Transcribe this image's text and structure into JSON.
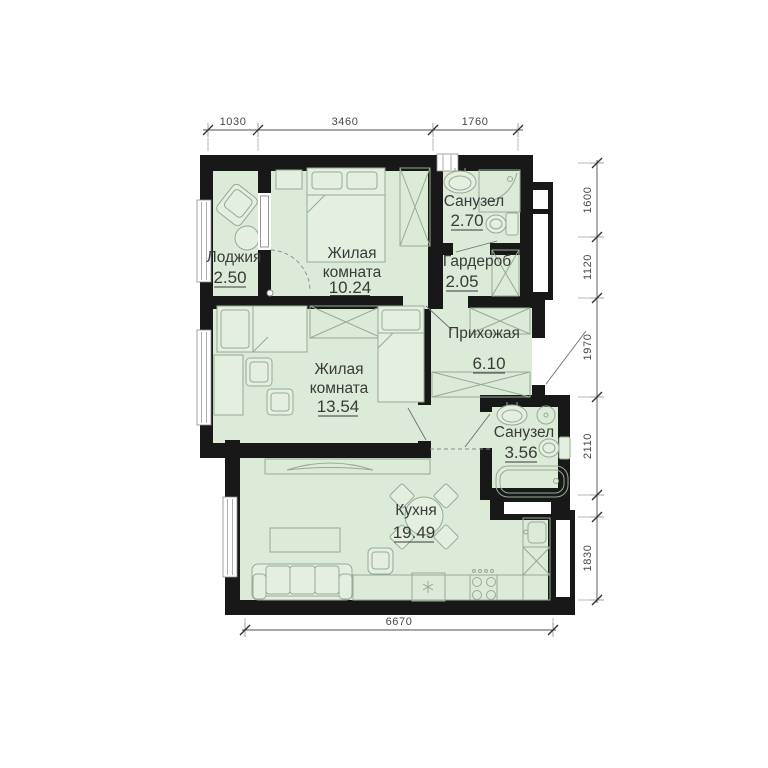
{
  "plan": {
    "type": "apartment-floor-plan",
    "rooms": [
      {
        "label": "Лоджия",
        "area": "2.50"
      },
      {
        "label_line1": "Жилая",
        "label_line2": "комната",
        "area": "10.24"
      },
      {
        "label": "Санузел",
        "area": "2.70"
      },
      {
        "label": "Гардероб",
        "area": "2.05"
      },
      {
        "label": "Прихожая",
        "area": "6.10"
      },
      {
        "label_line1": "Жилая",
        "label_line2": "комната",
        "area": "13.54"
      },
      {
        "label": "Санузел",
        "area": "3.56"
      },
      {
        "label": "Кухня",
        "area": "19.49"
      }
    ],
    "dimensions": {
      "top": [
        "1030",
        "3460",
        "1760"
      ],
      "right": [
        "1600",
        "1120",
        "1970",
        "2110",
        "1830"
      ],
      "bottom": [
        "6670"
      ]
    },
    "colors": {
      "room_fill": "#dcead8",
      "wall": "#181818",
      "furniture_stroke": "#96ab93",
      "text": "#3a3a3a"
    }
  }
}
